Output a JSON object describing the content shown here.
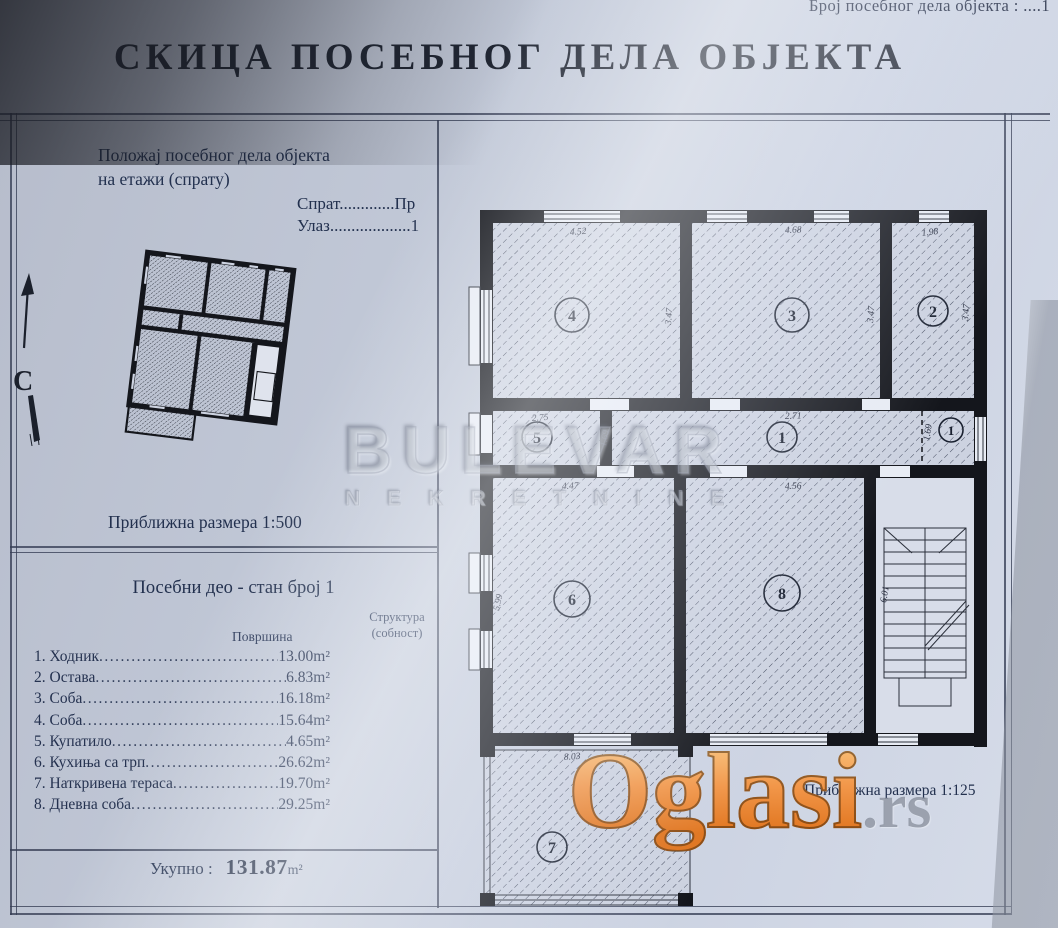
{
  "header": {
    "doc_no": "Број посебног дела објекта : ....1",
    "title": "СКИЦА ПОСЕБНОГ ДЕЛА ОБЈЕКТА"
  },
  "position": {
    "line1": "Положај посебног дела објекта",
    "line2": "на етажи (спрату)",
    "floor": "Спрат.............Пр",
    "entrance": "Улаз...................1",
    "north": "С",
    "scale": "Приближна размера 1:500"
  },
  "unit": {
    "heading": "Посебни део - стан број 1",
    "col_area": "Површина",
    "col_struct1": "Структура",
    "col_struct2": "(собност)",
    "rooms": [
      {
        "no": "1.",
        "name": "Ходник",
        "area": "13.00",
        "unit": "m²"
      },
      {
        "no": "2.",
        "name": "Остава",
        "area": "6.83",
        "unit": "m²"
      },
      {
        "no": "3.",
        "name": "Соба",
        "area": "16.18",
        "unit": "m²"
      },
      {
        "no": "4.",
        "name": "Соба",
        "area": "15.64",
        "unit": "m²"
      },
      {
        "no": "5.",
        "name": "Купатило",
        "area": "4.65",
        "unit": "m²"
      },
      {
        "no": "6.",
        "name": "Кухиња са трп",
        "area": "26.62",
        "unit": "m²"
      },
      {
        "no": "7.",
        "name": "Наткривена тераса",
        "area": "19.70",
        "unit": "m²"
      },
      {
        "no": "8.",
        "name": "Дневна соба",
        "area": "29.25",
        "unit": "m²"
      }
    ],
    "total_label": "Укупно :",
    "total_value": "131.87",
    "total_unit": "m²"
  },
  "plan": {
    "scale": "Приближна размера  1:125",
    "room_numbers": [
      "4",
      "3",
      "2",
      "5",
      "1",
      "1",
      "6",
      "8",
      "7"
    ],
    "dimensions": [
      "4.52",
      "3.47",
      "4.68",
      "3.47",
      "1.98",
      "3.47",
      "2.75",
      "1.69",
      "2.71",
      "1.69",
      "4.47",
      "5.99",
      "4.56",
      "6.01",
      "8.03"
    ]
  },
  "watermarks": {
    "brand": "BULEVAR",
    "brand_sub": "NEKRETNINE",
    "portal": "Oglasi",
    "portal_tld": ".rs"
  },
  "colors": {
    "paper": "#c4cbda",
    "ink": "#22304e",
    "wall": "#14161c",
    "orange": "#ec8a3e"
  }
}
